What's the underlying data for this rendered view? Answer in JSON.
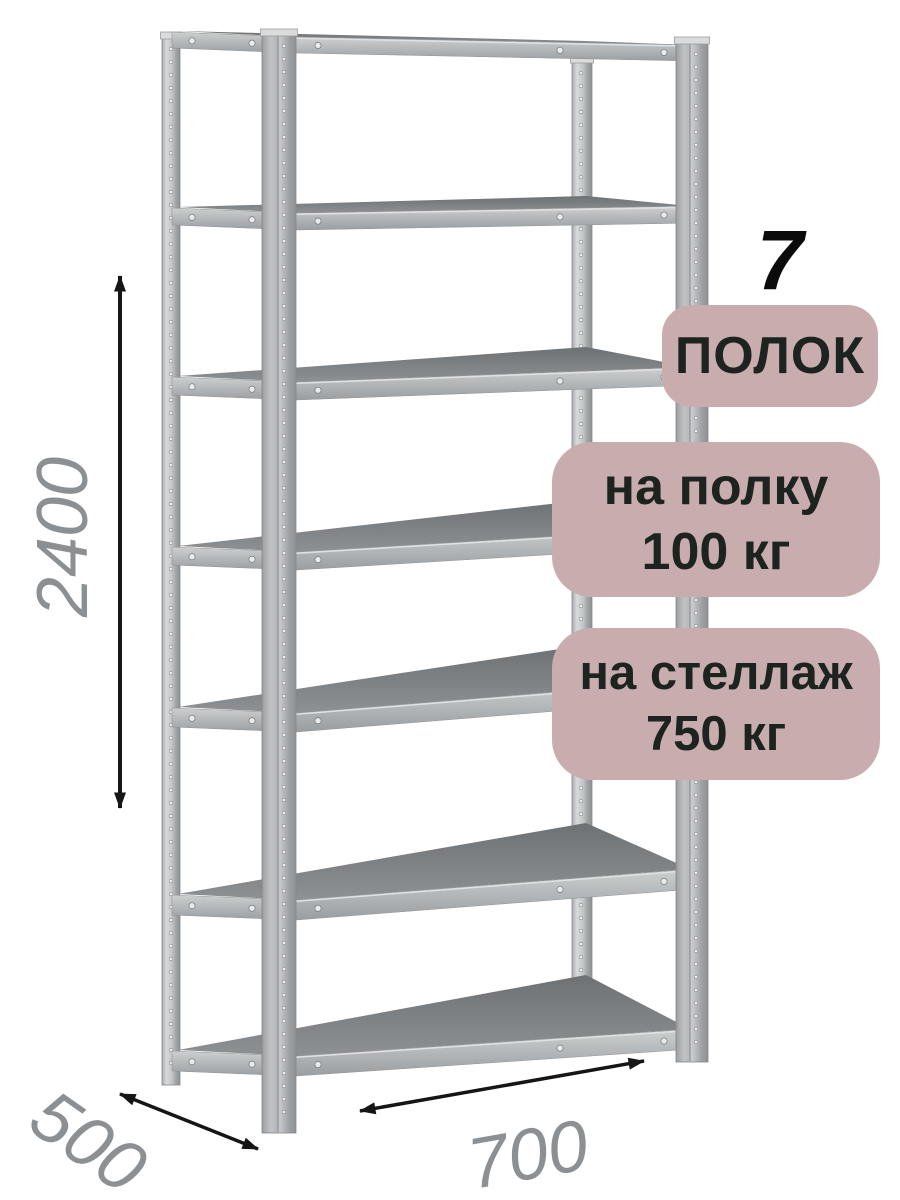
{
  "product": {
    "shelves_count": "7",
    "shelves_label": "ПОЛОК",
    "per_shelf_label": "на полку",
    "per_shelf_value": "100 кг",
    "per_rack_label": "на стеллаж",
    "per_rack_value": "750 кг"
  },
  "dimensions": {
    "height_mm": "2400",
    "depth_mm": "500",
    "width_mm": "700"
  },
  "colors": {
    "badge_bg": "#c9adae",
    "badge_text": "#1d231e",
    "arrow": "#151515",
    "dimension_text": "#8d9092",
    "metal_light": "#d8dadb",
    "metal_mid": "#b4b7b9",
    "metal_dark": "#8f9295",
    "shelf_surface": "#7f8285"
  }
}
